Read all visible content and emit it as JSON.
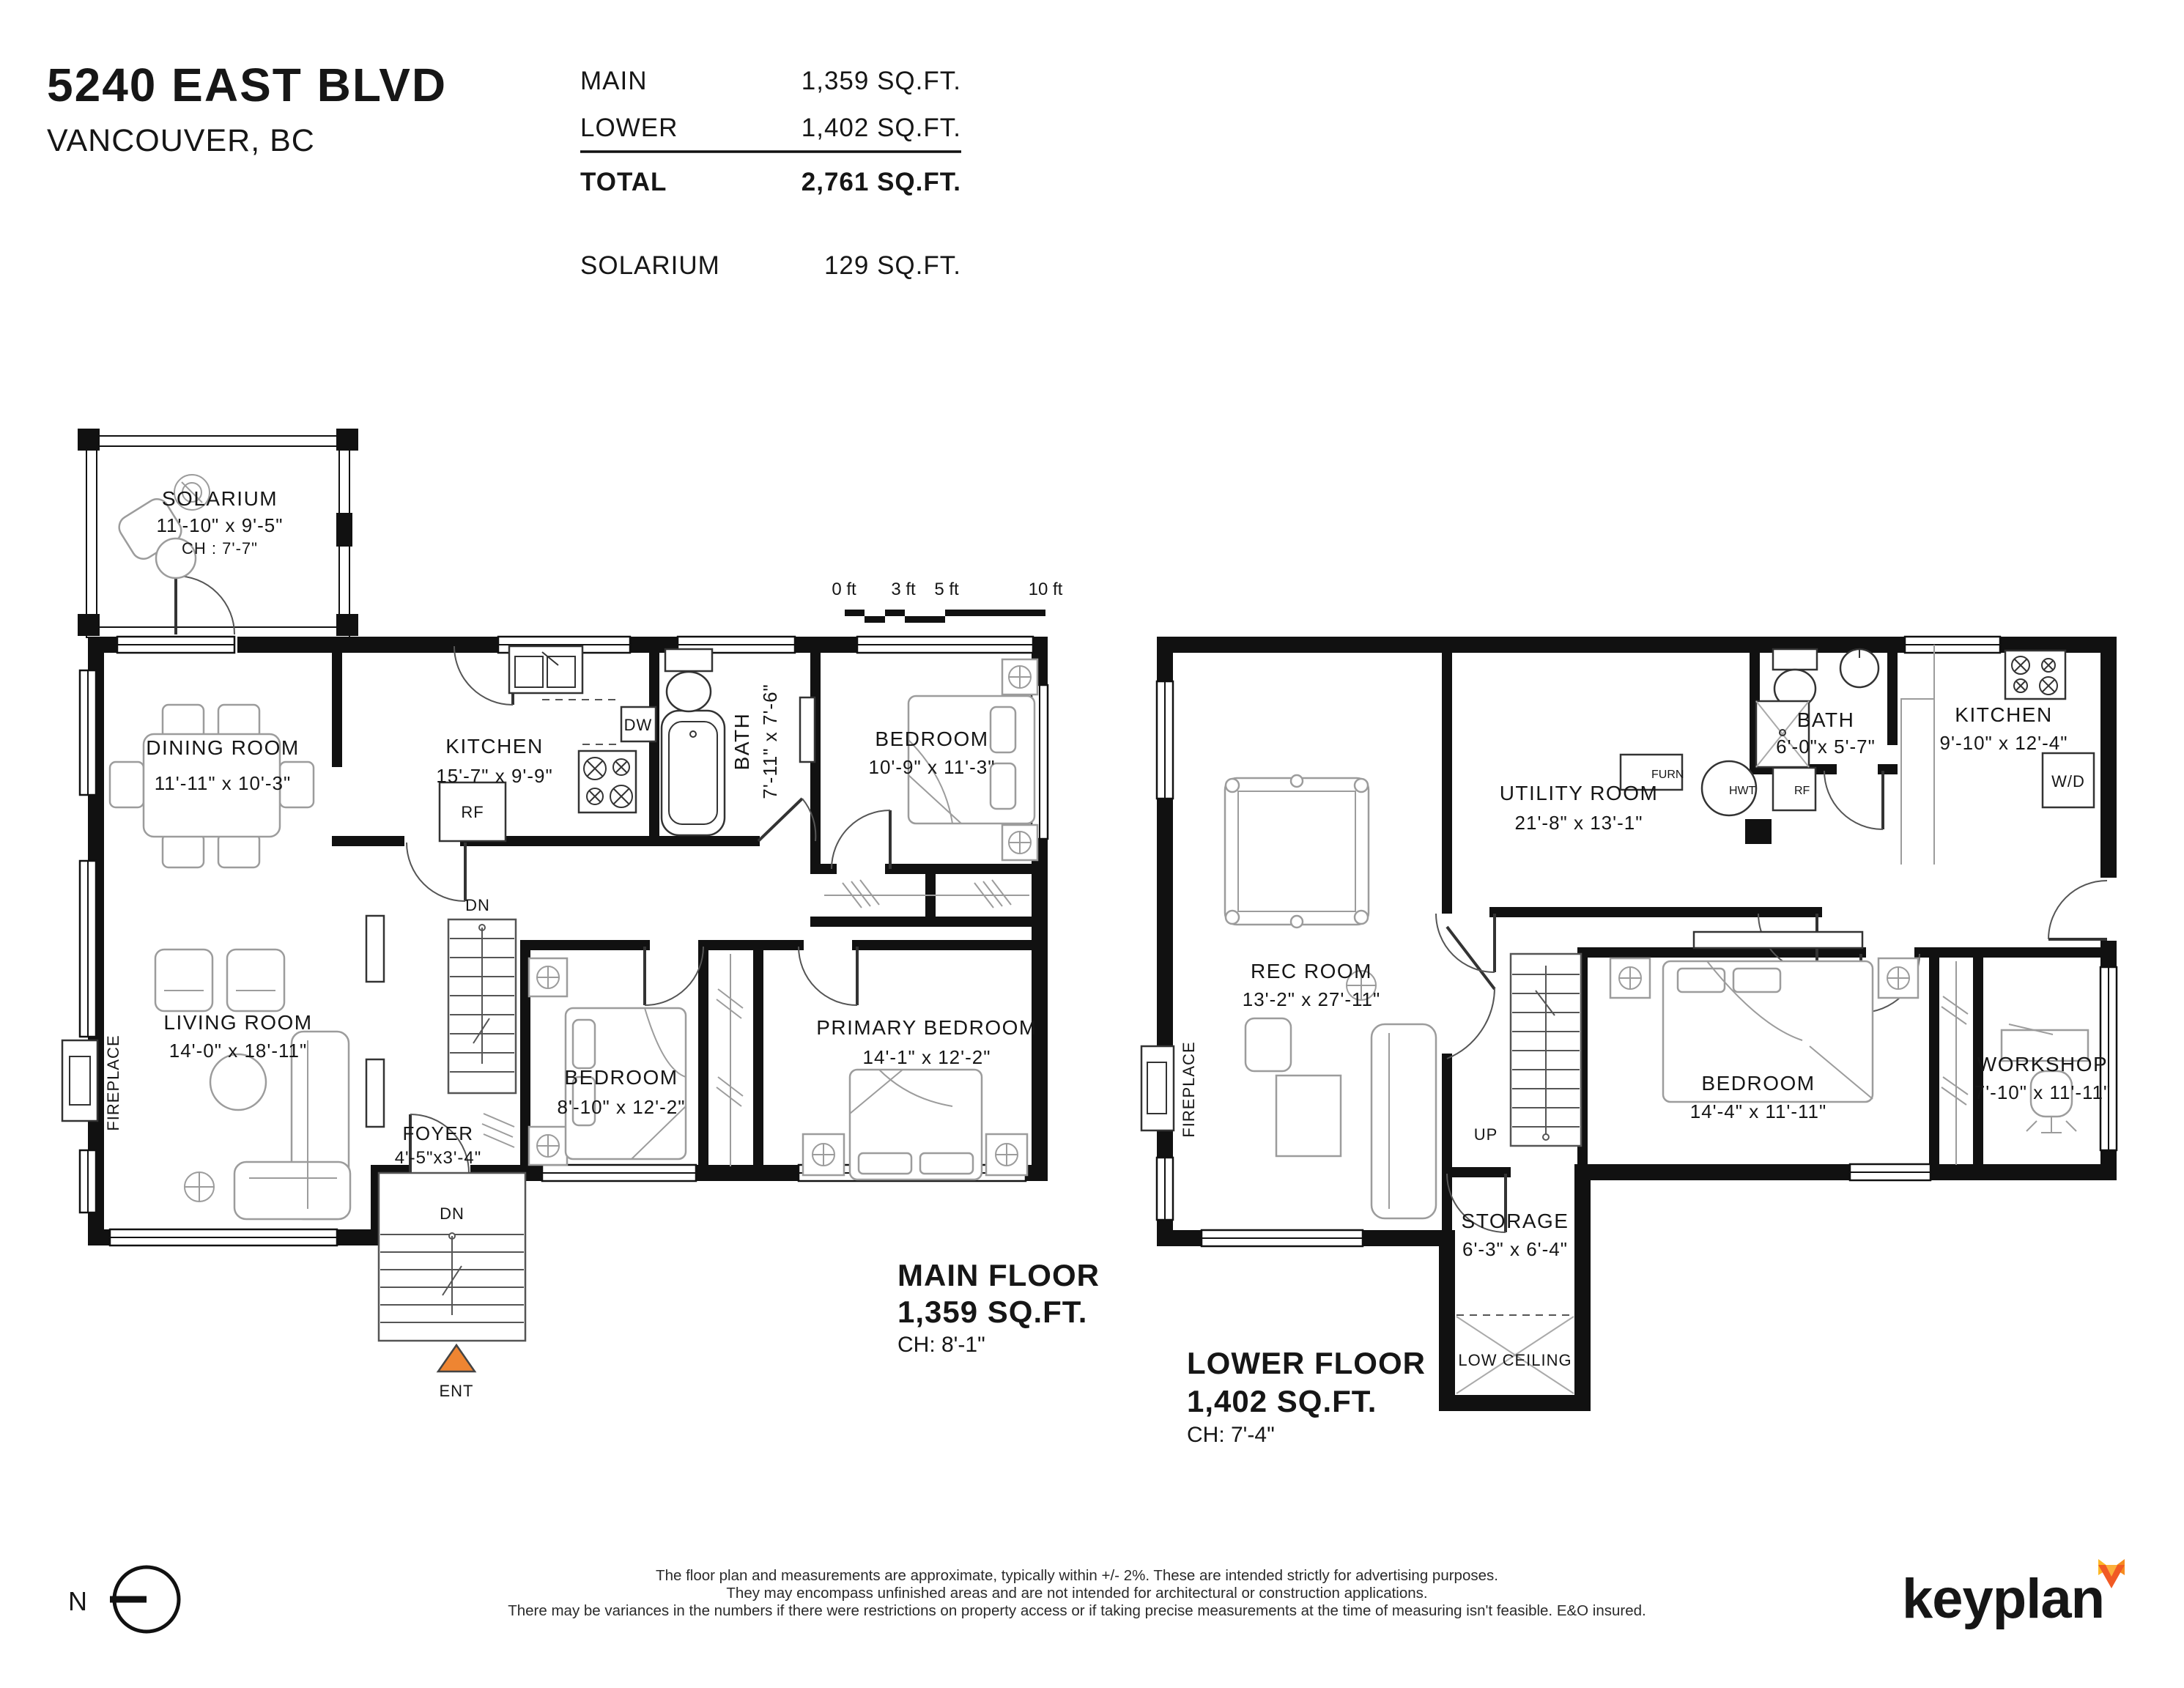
{
  "header": {
    "address": "5240 EAST BLVD",
    "city": "VANCOUVER, BC",
    "rows": [
      {
        "label": "MAIN",
        "value": "1,359 SQ.FT."
      },
      {
        "label": "LOWER",
        "value": "1,402 SQ.FT."
      }
    ],
    "total_label": "TOTAL",
    "total_value": "2,761 SQ.FT.",
    "solarium_label": "SOLARIUM",
    "solarium_value": "129 SQ.FT."
  },
  "scale_bar": {
    "t0": "0 ft",
    "t3": "3 ft",
    "t5": "5 ft",
    "t10": "10 ft"
  },
  "main_floor": {
    "title": "MAIN FLOOR",
    "area": "1,359 SQ.FT.",
    "ch": "CH: 8'-1\"",
    "rooms": {
      "solarium": {
        "name": "SOLARIUM",
        "dims": "11'-10\" x 9'-5\"",
        "ch": "CH : 7'-7\""
      },
      "dining": {
        "name": "DINING ROOM",
        "dims": "11'-11\" x 10'-3\""
      },
      "kitchen": {
        "name": "KITCHEN",
        "dims": "15'-7\" x 9'-9\""
      },
      "bath": {
        "name": "BATH",
        "dims": "7'-11\" x 7'-6\""
      },
      "bedroom1": {
        "name": "BEDROOM",
        "dims": "10'-9\" x 11'-3\""
      },
      "living": {
        "name": "LIVING ROOM",
        "dims": "14'-0\" x 18'-11\""
      },
      "bedroom2": {
        "name": "BEDROOM",
        "dims": "8'-10\" x 12'-2\""
      },
      "primary": {
        "name": "PRIMARY BEDROOM",
        "dims": "14'-1\" x 12'-2\""
      },
      "foyer": {
        "name": "FOYER",
        "dims": "4'-5\"x3'-4\""
      }
    },
    "labels": {
      "dw": "DW",
      "rf": "RF",
      "dn_stairs": "DN",
      "dn_entry": "DN",
      "ent": "ENT",
      "fireplace": "FIREPLACE"
    }
  },
  "lower_floor": {
    "title": "LOWER FLOOR",
    "area": "1,402 SQ.FT.",
    "ch": "CH: 7'-4\"",
    "rooms": {
      "rec": {
        "name": "REC ROOM",
        "dims": "13'-2\" x 27'-11\""
      },
      "utility": {
        "name": "UTILITY ROOM",
        "dims": "21'-8\" x 13'-1\""
      },
      "bath": {
        "name": "BATH",
        "dims": "6'-0\"x 5'-7\""
      },
      "kitchen": {
        "name": "KITCHEN",
        "dims": "9'-10\" x 12'-4\""
      },
      "bedroom": {
        "name": "BEDROOM",
        "dims": "14'-4\" x 11'-11\""
      },
      "workshop": {
        "name": "WORKSHOP",
        "dims": "7'-10\" x 11'-11\""
      },
      "storage": {
        "name": "STORAGE",
        "dims": "6'-3\" x 6'-4\"",
        "note": "LOW CEILING"
      }
    },
    "labels": {
      "furn": "FURN",
      "hwt": "HWT",
      "rf": "RF",
      "wd": "W/D",
      "up": "UP",
      "fireplace": "FIREPLACE"
    }
  },
  "footer": {
    "disclaimer1": "The floor plan and measurements are approximate, typically within +/- 2%. These are intended strictly for advertising purposes.",
    "disclaimer2": "They may encompass unfinished areas and are not intended for architectural or construction applications.",
    "disclaimer3": "There may be variances in the numbers if there were restrictions on property access or if taking precise measurements at the time of measuring isn't feasible. E&O insured.",
    "north": "N",
    "logo": "keyplan"
  },
  "colors": {
    "accent_orange": "#EE8532",
    "ink": "#111111",
    "furniture_gray": "#9c9c9c"
  }
}
